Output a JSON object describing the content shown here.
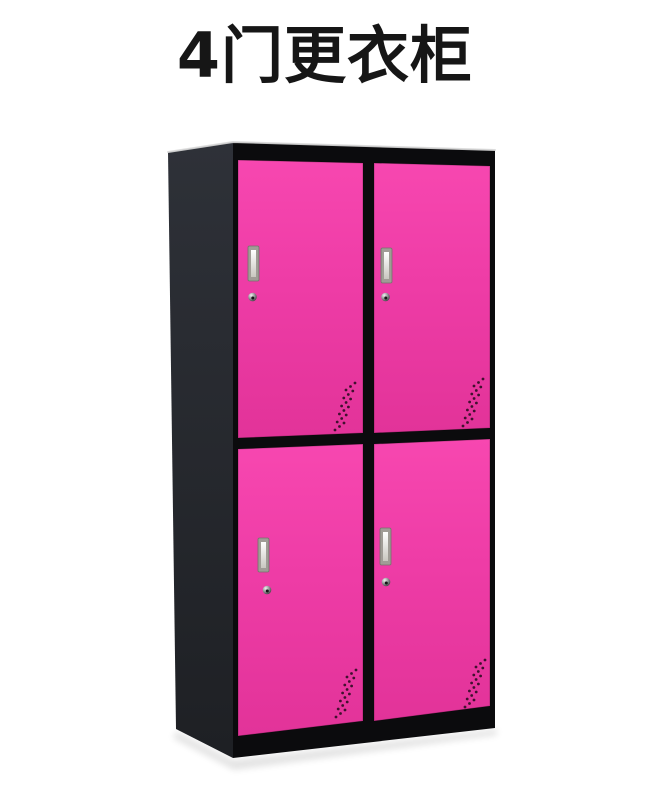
{
  "page": {
    "background": "#ffffff"
  },
  "header": {
    "title": "4门更衣柜",
    "color": "#161616"
  },
  "product_image": {
    "description": "4-door steel locker cabinet, black frame with pink doors",
    "door_count": 4,
    "doors": [
      {
        "id": "top-left",
        "parts": [
          "handle",
          "keyhole",
          "vent-holes"
        ]
      },
      {
        "id": "top-right",
        "parts": [
          "handle",
          "keyhole",
          "vent-holes"
        ]
      },
      {
        "id": "bottom-left",
        "parts": [
          "handle",
          "keyhole",
          "vent-holes"
        ]
      },
      {
        "id": "bottom-right",
        "parts": [
          "handle",
          "keyhole",
          "vent-holes"
        ]
      }
    ],
    "colors": {
      "door_pink": "#ee3ca6",
      "door_pink_light": "#f747b0",
      "door_pink_dark": "#e23399",
      "frame_black": "#0b0b0d",
      "side_panel_top": "#2e3138",
      "side_panel_bottom": "#1e2024",
      "handle_outer": "#a09c96",
      "handle_border": "#75726b",
      "handle_inner_light": "#ffffff",
      "handle_inner_dark": "#c9c7c0",
      "lock_light": "#f2f2f2",
      "lock_mid": "#8f8f92",
      "lock_dark": "#2a2a2c",
      "vent_dot": "#40102e",
      "edge_highlight": "#d9d9d9",
      "shadow": "#000000"
    }
  }
}
